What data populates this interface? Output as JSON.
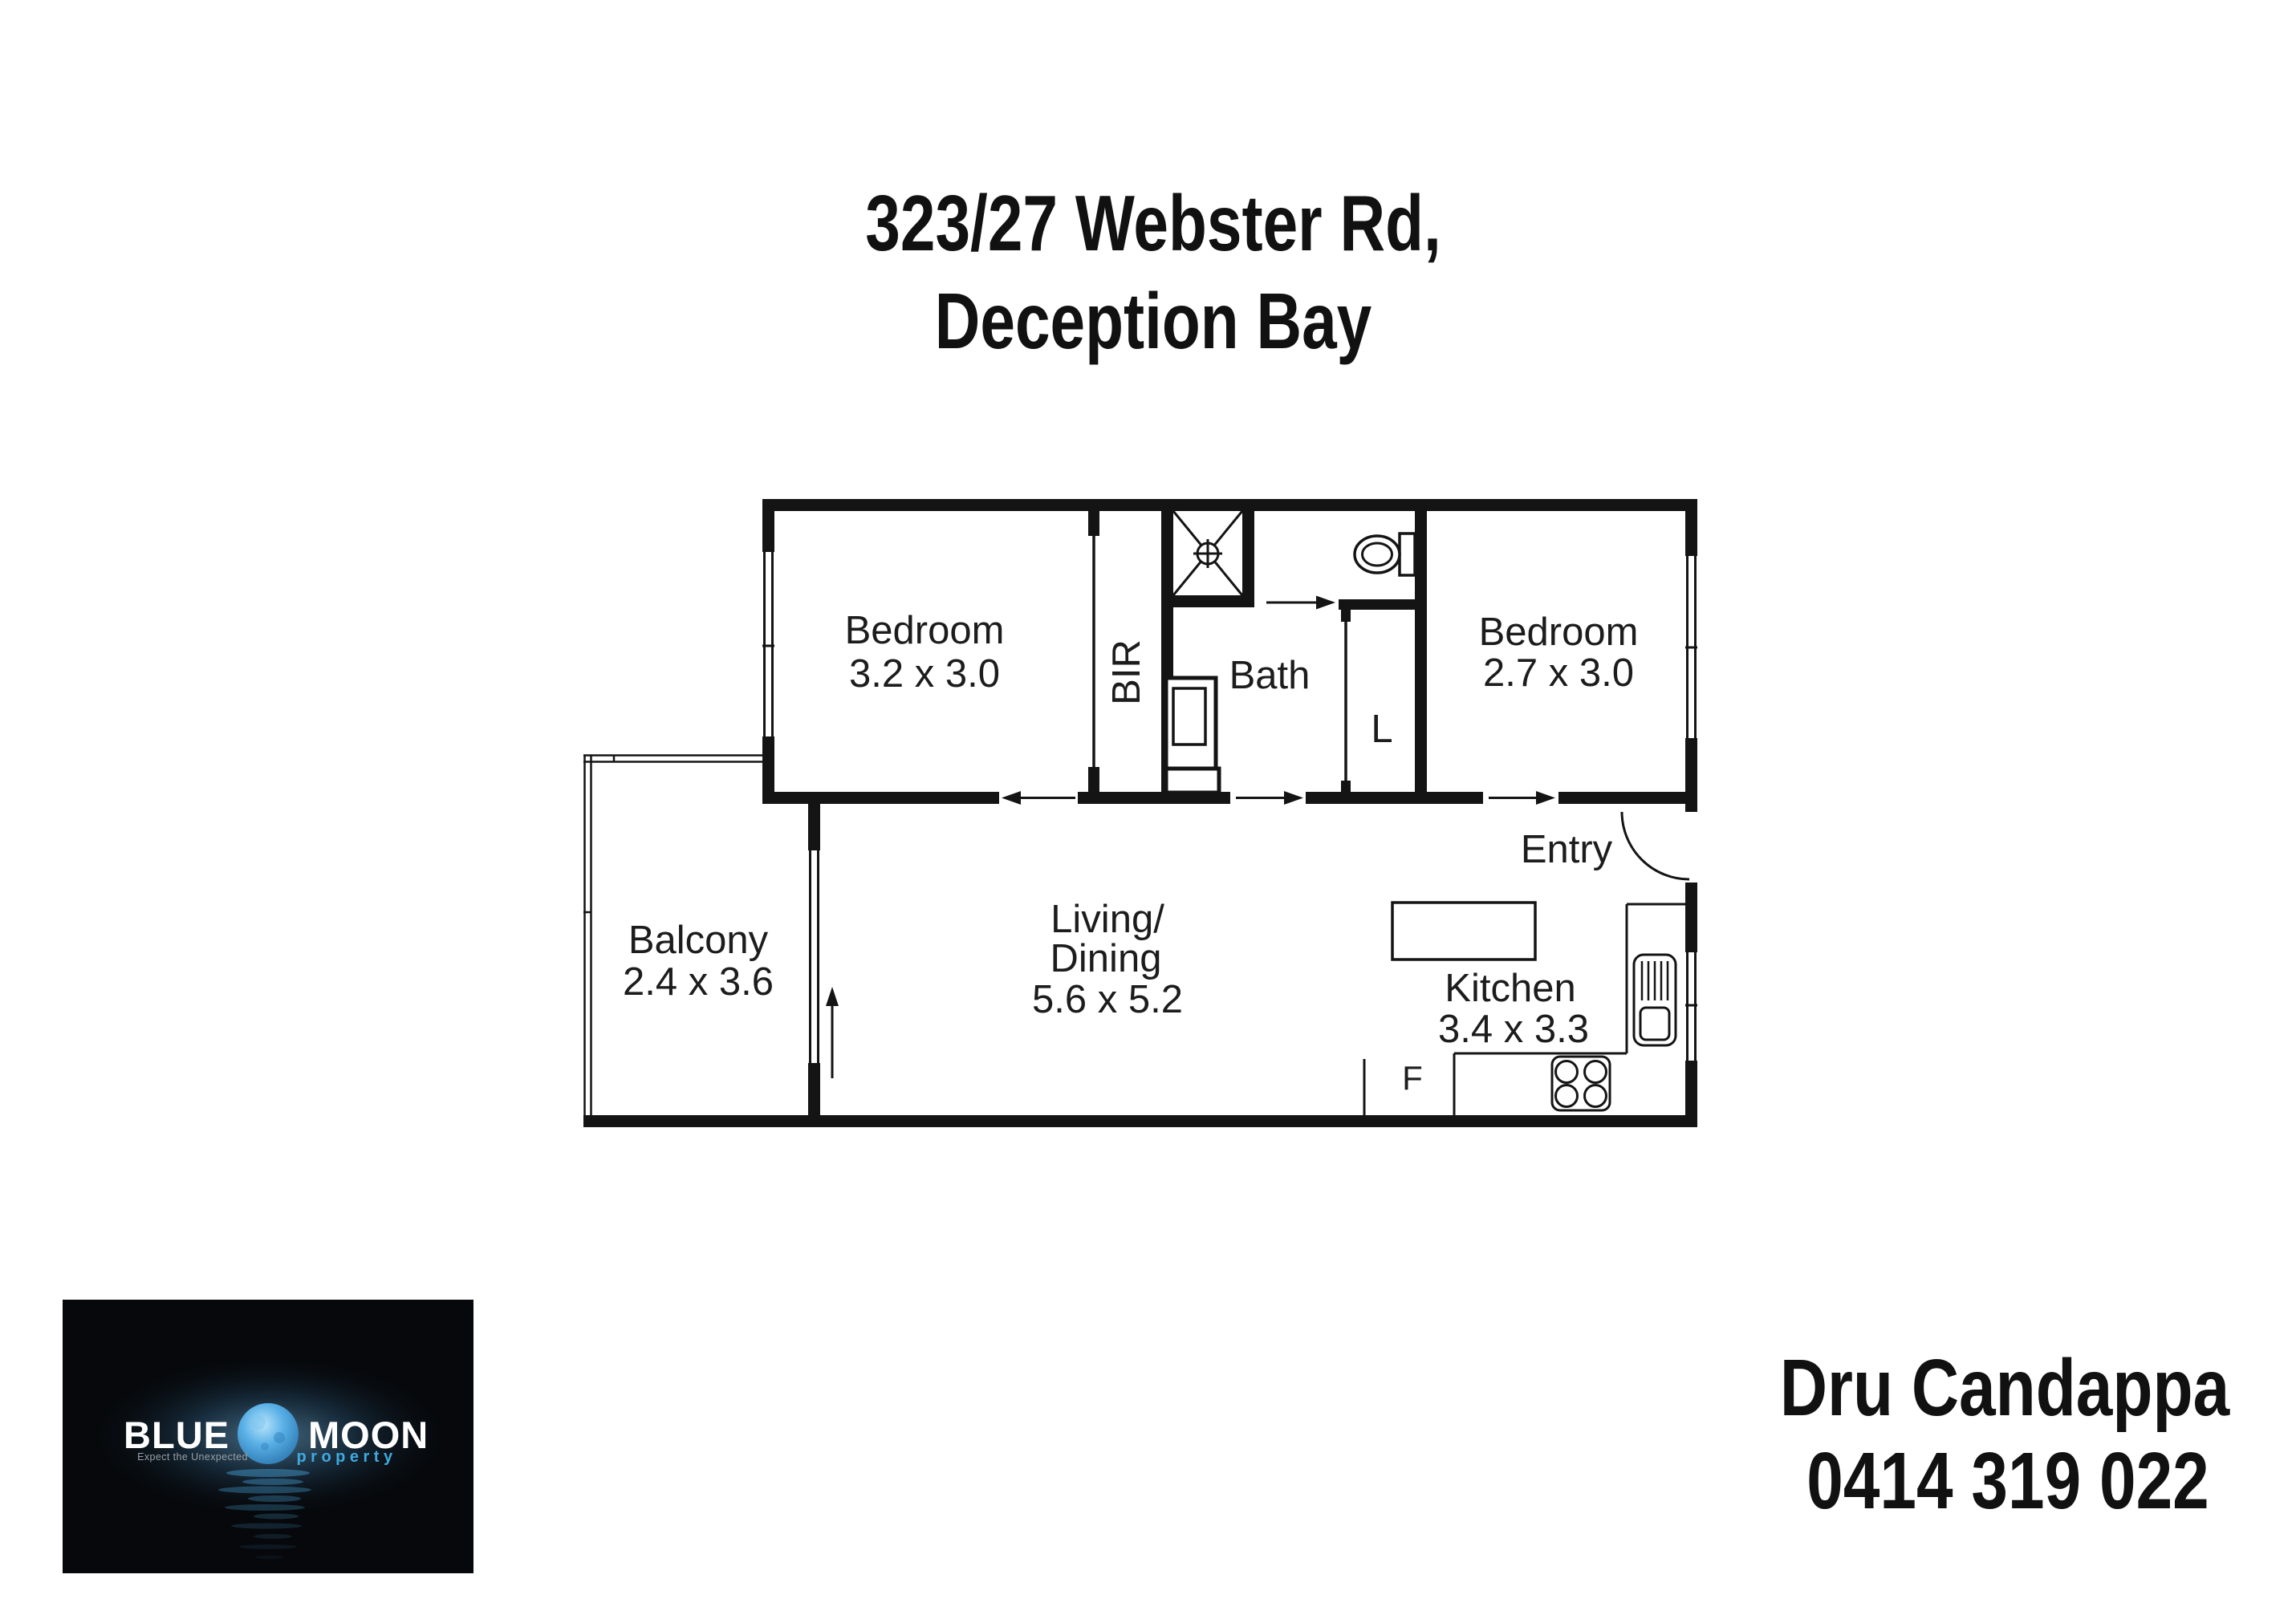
{
  "title": {
    "line1": "323/27 Webster Rd,",
    "line2": "Deception Bay"
  },
  "floorplan": {
    "bedroom1": {
      "name": "Bedroom",
      "dims": "3.2 x 3.0"
    },
    "bedroom2": {
      "name": "Bedroom",
      "dims": "2.7 x 3.0"
    },
    "bath": {
      "name": "Bath"
    },
    "robe": {
      "abbr": "BIR"
    },
    "linen": {
      "abbr": "L"
    },
    "entry": {
      "name": "Entry"
    },
    "balcony": {
      "name": "Balcony",
      "dims": "2.4 x 3.6"
    },
    "living": {
      "line1": "Living/",
      "line2": "Dining",
      "dims": "5.6 x 5.2"
    },
    "kitchen": {
      "name": "Kitchen",
      "dims": "3.4 x 3.3"
    },
    "fridge": {
      "abbr": "F"
    }
  },
  "logo": {
    "brand_left": "BLUE",
    "brand_right": "MOON",
    "tagline": "Expect the Unexpected",
    "subbrand": "property"
  },
  "agent": {
    "name": "Dru Candappa",
    "phone": "0414 319 022"
  },
  "colors": {
    "walls": "#141414",
    "logo_bg": "#06080b",
    "moon_blue": "#4fb2ec",
    "property_blue": "#3fa9e0",
    "tagline_gray": "#9aa0a6",
    "text": "#1c1c1c"
  }
}
